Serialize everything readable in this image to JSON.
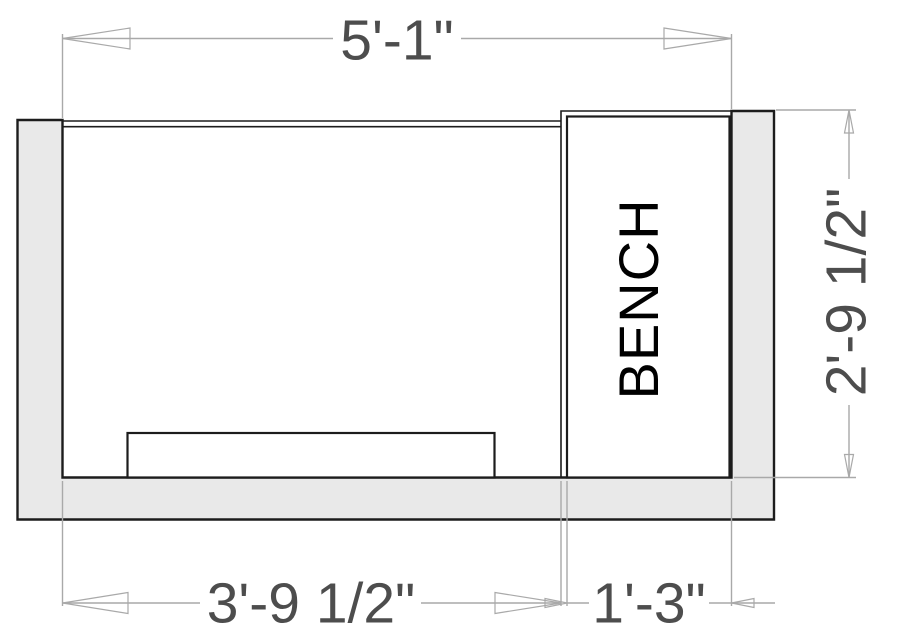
{
  "drawing": {
    "type": "floor-plan",
    "labels": {
      "bench": "BENCH"
    },
    "dimensions": {
      "top_width": "5'-1\"",
      "bottom_left_width": "3'-9 1/2\"",
      "bottom_right_width": "1'-3\"",
      "right_height": "2'-9 1/2\""
    },
    "colors": {
      "background": "#ffffff",
      "wall_fill": "#e9e9e9",
      "wall_stroke": "#1c1c1c",
      "dimension_line": "#a9a9a9",
      "dimension_text": "#4d4d4d",
      "bench_text": "#000000"
    }
  }
}
